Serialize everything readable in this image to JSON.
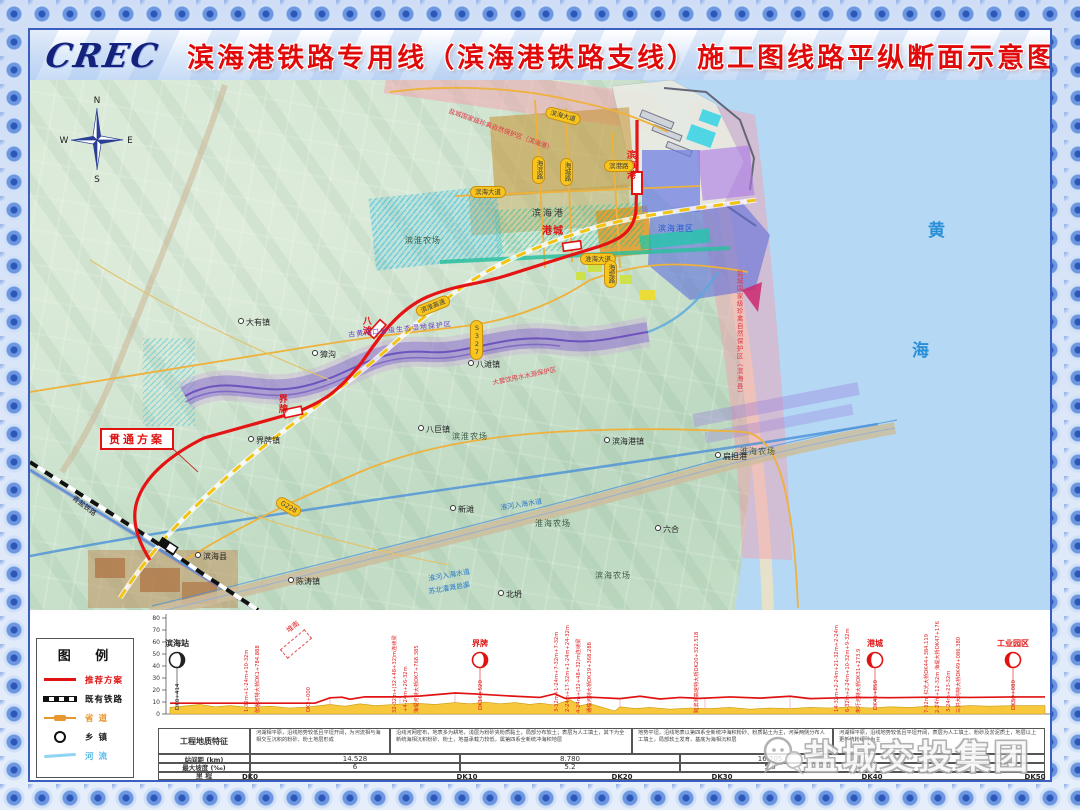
{
  "title": {
    "logo": "CREC",
    "text": "滨海港铁路专用线（滨海港铁路支线）施工图线路平纵断面示意图"
  },
  "compass": {
    "n": "N",
    "e": "E",
    "s": "S",
    "w": "W"
  },
  "colors": {
    "route": "#e01212",
    "sea": "#b5d9f5",
    "terrain": "#f7c83c",
    "badge": "#f7c51e"
  },
  "map": {
    "plan_box_label": "贯通方案",
    "labels": [
      {
        "t": "大有镇",
        "c": "town",
        "x": 208,
        "y": 238
      },
      {
        "t": "獐沟",
        "c": "town",
        "x": 282,
        "y": 270
      },
      {
        "t": "界牌镇",
        "c": "town",
        "x": 218,
        "y": 356
      },
      {
        "t": "八巨镇",
        "c": "town",
        "x": 388,
        "y": 345
      },
      {
        "t": "八滩镇",
        "c": "town",
        "x": 438,
        "y": 280
      },
      {
        "t": "陈涛镇",
        "c": "town",
        "x": 258,
        "y": 497
      },
      {
        "t": "滨海港镇",
        "c": "town",
        "x": 574,
        "y": 357
      },
      {
        "t": "扁担港",
        "c": "town",
        "x": 685,
        "y": 372
      },
      {
        "t": "新滩",
        "c": "town",
        "x": 420,
        "y": 425
      },
      {
        "t": "六合",
        "c": "town",
        "x": 625,
        "y": 445
      },
      {
        "t": "北坍",
        "c": "town",
        "x": 468,
        "y": 510
      },
      {
        "t": "滨海县",
        "c": "town",
        "x": 165,
        "y": 472
      },
      {
        "t": "滨淮农场",
        "c": "farm",
        "x": 375,
        "y": 157
      },
      {
        "t": "滨淮农场",
        "c": "farm",
        "x": 422,
        "y": 353
      },
      {
        "t": "淮海农场",
        "c": "farm",
        "x": 710,
        "y": 368
      },
      {
        "t": "淮海农场",
        "c": "farm",
        "x": 505,
        "y": 440
      },
      {
        "t": "滨海农场",
        "c": "farm",
        "x": 565,
        "y": 492
      },
      {
        "t": "滨海港",
        "c": "area",
        "x": 502,
        "y": 130
      },
      {
        "t": "滨海港区",
        "c": "bluetxt",
        "x": 628,
        "y": 145
      },
      {
        "t": "黄",
        "c": "sea",
        "x": 898,
        "y": 142
      },
      {
        "t": "海",
        "c": "sea",
        "x": 882,
        "y": 262
      },
      {
        "t": "界牌",
        "c": "redv",
        "x": 246,
        "y": 314
      },
      {
        "t": "八滩",
        "c": "redv",
        "x": 330,
        "y": 236
      },
      {
        "t": "港城",
        "c": "redh",
        "x": 512,
        "y": 146
      },
      {
        "t": "滨海港",
        "c": "redv",
        "x": 594,
        "y": 70
      },
      {
        "t": "盐城国家级珍禽自然保护区（滨海县）",
        "c": "protv",
        "x": 705,
        "y": 190,
        "h": 200
      },
      {
        "t": "盐城国家级珍禽自然保护区（滨海港）",
        "c": "protr",
        "x": 420,
        "y": 28,
        "r": 20
      },
      {
        "t": "古黄河口省级生态湿地保护区",
        "c": "purp",
        "x": 318,
        "y": 252,
        "r": -6
      },
      {
        "t": "大套饮用水水源保护区",
        "c": "protr",
        "x": 462,
        "y": 300,
        "r": -12
      },
      {
        "t": "淮河入海水道",
        "c": "canal",
        "x": 398,
        "y": 496,
        "r": -10
      },
      {
        "t": "苏北灌溉总渠",
        "c": "canal",
        "x": 398,
        "y": 509,
        "r": -10
      },
      {
        "t": "淮河入海水道",
        "c": "canal",
        "x": 470,
        "y": 425,
        "r": -9
      },
      {
        "t": "青盐铁路",
        "c": "raillbl",
        "x": 45,
        "y": 415,
        "r": 38
      }
    ],
    "badges": [
      {
        "t": "滨海大道",
        "x": 440,
        "y": 106
      },
      {
        "t": "淮海大道",
        "x": 550,
        "y": 173
      },
      {
        "t": "滨淮高速",
        "x": 385,
        "y": 220,
        "r": -22
      },
      {
        "t": "滨海大道",
        "x": 515,
        "y": 30,
        "r": 15
      },
      {
        "t": "海堤路",
        "x": 574,
        "y": 180,
        "v": true
      },
      {
        "t": "海城路",
        "x": 530,
        "y": 78,
        "v": true
      },
      {
        "t": "滨港路",
        "x": 574,
        "y": 80
      },
      {
        "t": "海滨路",
        "x": 502,
        "y": 76,
        "v": true
      },
      {
        "t": "S327",
        "x": 440,
        "y": 240,
        "v": true
      },
      {
        "t": "G228",
        "x": 245,
        "y": 421,
        "r": 30
      }
    ]
  },
  "legend": {
    "title": "图  例",
    "items": [
      {
        "label": "推荐方案",
        "type": "route",
        "color": "#e01212"
      },
      {
        "label": "既有铁路",
        "type": "rail",
        "color": "#111111"
      },
      {
        "label": "省  道",
        "type": "road",
        "color": "#e8972e"
      },
      {
        "label": "乡  镇",
        "type": "town",
        "color": "#222222"
      },
      {
        "label": "河  流",
        "type": "river",
        "color": "#58b8e8"
      }
    ]
  },
  "profile": {
    "axis_values": [
      80,
      70,
      60,
      50,
      40,
      30,
      20,
      10,
      0
    ],
    "branch_label": "堆南",
    "stations": [
      {
        "name": "滨海站",
        "x": 37,
        "mile": "DK0+414",
        "color": "#222222",
        "side": "right"
      },
      {
        "name": "界牌",
        "x": 340,
        "mile": "DK16+520",
        "color": "#e01212",
        "side": "right"
      },
      {
        "name": "港城",
        "x": 735,
        "mile": "DK41+850",
        "color": "#e01212",
        "side": "left"
      },
      {
        "name": "工业园区",
        "x": 873,
        "mile": "DK50+080",
        "color": "#e01212",
        "side": "left"
      }
    ],
    "annotations": [
      {
        "x": 110,
        "t": "1-32m+1-24m+10-32m"
      },
      {
        "x": 121,
        "t": "张家河特大桥DK1+784.888"
      },
      {
        "x": 172,
        "t": "DK2+000"
      },
      {
        "x": 258,
        "t": "32-32m+(32+48+32)m连续梁"
      },
      {
        "x": 269,
        "t": "+4-24m+26-32m"
      },
      {
        "x": 280,
        "t": "海堤河特大桥DK7+768.385"
      },
      {
        "x": 420,
        "t": "3-32m+1-24m+7-32m+7-32m"
      },
      {
        "x": 431,
        "t": "2-24m+17-32m+1-24m+24-32m"
      },
      {
        "x": 442,
        "t": "4-24m+(32+48+32)m连续梁"
      },
      {
        "x": 453,
        "t": "通榆河特大桥DK19+368.288"
      },
      {
        "x": 560,
        "t": "跨滨淮高速特大桥DK20+322.518"
      },
      {
        "x": 700,
        "t": "14-32m+2-24m+21-32m+2-24m"
      },
      {
        "x": 711,
        "t": "6-32m+2-24m+10-32m+9-32m"
      },
      {
        "x": 722,
        "t": "朱圩河特大桥DK31+273.9"
      },
      {
        "x": 790,
        "t": "7-32m 红光大桥DK44+384.119"
      },
      {
        "x": 801,
        "t": "2-24m+12-32m 海堤大桥DK47+176"
      },
      {
        "x": 812,
        "t": "3-24m+23-32m"
      },
      {
        "x": 822,
        "t": "三洪大沟特大桥DK49+086.380"
      }
    ],
    "line_points": [
      [
        30,
        9
      ],
      [
        175,
        9
      ],
      [
        190,
        13.5
      ],
      [
        202,
        14
      ],
      [
        210,
        12.3
      ],
      [
        225,
        14.3
      ],
      [
        260,
        14.3
      ],
      [
        280,
        15
      ],
      [
        315,
        17.5
      ],
      [
        340,
        16.5
      ],
      [
        370,
        15
      ],
      [
        400,
        13.8
      ],
      [
        415,
        16.8
      ],
      [
        425,
        13
      ],
      [
        450,
        14
      ],
      [
        480,
        12.8
      ],
      [
        500,
        14.8
      ],
      [
        520,
        12.5
      ],
      [
        540,
        13.8
      ],
      [
        560,
        13
      ],
      [
        590,
        14.2
      ],
      [
        620,
        13.2
      ],
      [
        650,
        14.8
      ],
      [
        670,
        12.8
      ],
      [
        695,
        13.4
      ],
      [
        720,
        13.8
      ],
      [
        750,
        13.6
      ],
      [
        790,
        14
      ],
      [
        830,
        13.8
      ],
      [
        875,
        14.2
      ],
      [
        905,
        14.2
      ]
    ],
    "terrain_points": [
      [
        30,
        5.5
      ],
      [
        60,
        8
      ],
      [
        75,
        6
      ],
      [
        90,
        7
      ],
      [
        110,
        5.5
      ],
      [
        130,
        6.5
      ],
      [
        150,
        5
      ],
      [
        170,
        6
      ],
      [
        190,
        8
      ],
      [
        205,
        6.5
      ],
      [
        220,
        8.5
      ],
      [
        235,
        7
      ],
      [
        255,
        8
      ],
      [
        275,
        9
      ],
      [
        295,
        8
      ],
      [
        315,
        9.5
      ],
      [
        330,
        8.5
      ],
      [
        345,
        10
      ],
      [
        360,
        8.5
      ],
      [
        375,
        9.5
      ],
      [
        390,
        8
      ],
      [
        400,
        9
      ],
      [
        415,
        7.5
      ],
      [
        430,
        12
      ],
      [
        440,
        7
      ],
      [
        450,
        8.5
      ],
      [
        465,
        5
      ],
      [
        475,
        2.5
      ],
      [
        480,
        6
      ],
      [
        495,
        4.5
      ],
      [
        510,
        5.5
      ],
      [
        530,
        4
      ],
      [
        550,
        5
      ],
      [
        570,
        4.5
      ],
      [
        590,
        5.5
      ],
      [
        610,
        4
      ],
      [
        630,
        5
      ],
      [
        650,
        4.5
      ],
      [
        670,
        5.5
      ],
      [
        690,
        5
      ],
      [
        710,
        6
      ],
      [
        730,
        5
      ],
      [
        750,
        6
      ],
      [
        770,
        5.5
      ],
      [
        790,
        6.5
      ],
      [
        810,
        6
      ],
      [
        830,
        7
      ],
      [
        850,
        6.5
      ],
      [
        875,
        7
      ],
      [
        905,
        7
      ]
    ],
    "drop_lines": [
      [
        120,
        9,
        6
      ],
      [
        190,
        13.5,
        8
      ],
      [
        260,
        14.3,
        8
      ],
      [
        315,
        17.5,
        9.5
      ],
      [
        430,
        13,
        12
      ],
      [
        480,
        12.8,
        6
      ],
      [
        565,
        13,
        4.5
      ],
      [
        650,
        14.8,
        4.5
      ],
      [
        705,
        13.5,
        6
      ],
      [
        795,
        14,
        6.5
      ],
      [
        875,
        14.2,
        7
      ]
    ]
  },
  "table": {
    "row_labels": {
      "geology": "工程地质特征",
      "spacing": "站间距 (km)",
      "gradient": "最大坡度 (‰)",
      "mileage": "里  程"
    },
    "geology_bounds": [
      18,
      110,
      250,
      492,
      693,
      905
    ],
    "geology_cells": [
      "河湖相平原，沿线地势较低且平坦开阔，为河流相与海相交互沉积的粉砂、粉土地层形成",
      "沿线河网密布，地表多为耕地，浅层为粉砂夹粉质黏土，局部分布软土；表层为人工填土，其下为全新统海相沉积粉砂、粉土，地基承载力较低，属第四系全新统冲海积地层",
      "地势平坦，沿线地表以第四系全新统冲海积粉砂、粉质黏土为主，河渠两侧分布人工填土，局部软土发育，基底为海相沉积层",
      "河湖相平原，沿线地势较低且平坦开阔，表层为人工填土、粉砂及淤泥质土，地层以上更新统粉细砂为主"
    ],
    "value_bounds": [
      18,
      110,
      320,
      540,
      720,
      905
    ],
    "spacing_values": [
      "14.528",
      "8.780",
      "16.705",
      ""
    ],
    "gradient_values": [
      "6",
      "5.2",
      "5.8",
      ""
    ],
    "mileage_marks": [
      {
        "t": "DK0",
        "x": 85
      },
      {
        "t": "DK10",
        "x": 302
      },
      {
        "t": "DK20",
        "x": 457
      },
      {
        "t": "DK30",
        "x": 557
      },
      {
        "t": "DK40",
        "x": 707
      },
      {
        "t": "DK50",
        "x": 870
      }
    ]
  },
  "watermark": {
    "text": "盐城交投集团"
  }
}
